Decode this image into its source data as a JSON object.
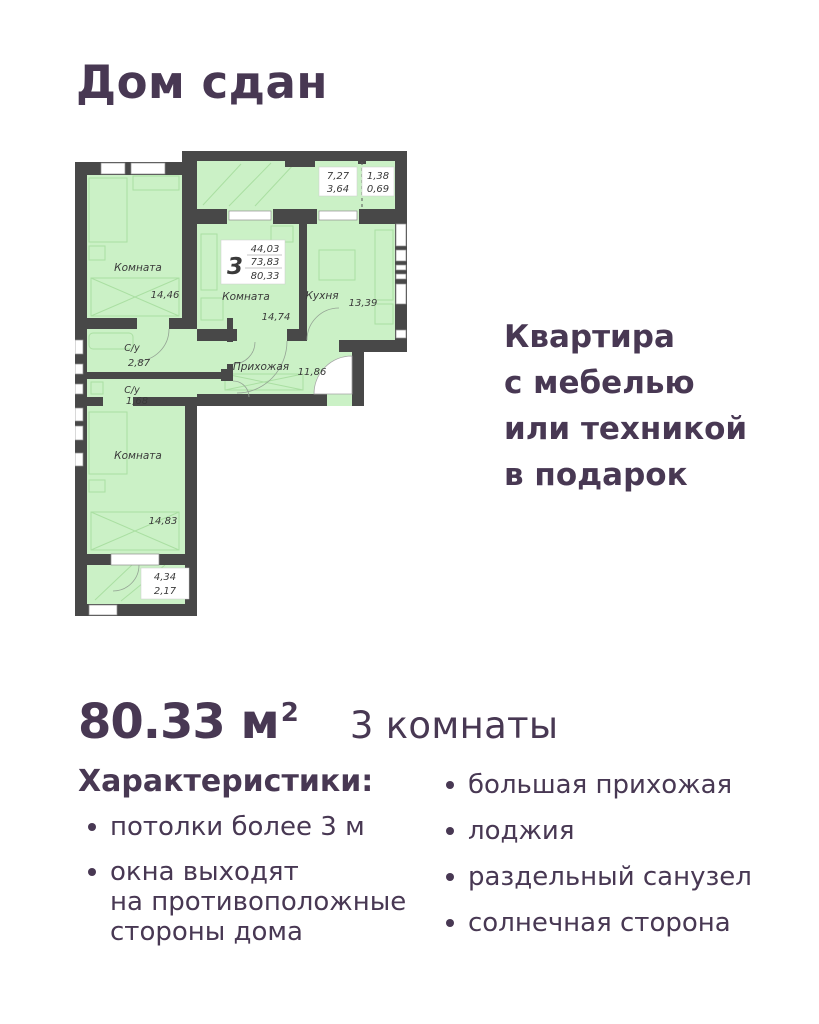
{
  "theme": {
    "text_color": "#483853",
    "background": "#ffffff"
  },
  "page": {
    "title": "Дом сдан",
    "promo": {
      "line1": "Квартира",
      "line2": "с мебелью",
      "line3": "или техникой",
      "line4": "в подарок"
    },
    "summary": {
      "area": "80.33 м",
      "area_sup": "2",
      "rooms": "3 комнаты"
    },
    "characteristics": {
      "heading": "Характеристики:",
      "left_items": [
        {
          "l1": "потолки более 3 м",
          "l2": "",
          "l3": ""
        },
        {
          "l1": "окна выходят",
          "l2": "на противоположные",
          "l3": "стороны дома"
        }
      ],
      "right_items": [
        {
          "label": "большая прихожая"
        },
        {
          "label": "лоджия"
        },
        {
          "label": "раздельный санузел"
        },
        {
          "label": "солнечная сторона"
        }
      ]
    }
  },
  "floor_plan": {
    "colors": {
      "wall": "#484848",
      "room_fill": "#cbf1c6",
      "label_text": "#3a3a3a"
    },
    "stamp": {
      "rooms": "3",
      "area1": "44,03",
      "area2": "73,83",
      "area3": "80,33"
    },
    "rooms": [
      {
        "name": "Комната",
        "area": "14,46"
      },
      {
        "name": "Комната",
        "area": "14,74"
      },
      {
        "name": "Кухня",
        "area": "13,39"
      },
      {
        "name": "С/у",
        "area": "2,87"
      },
      {
        "name": "С/у",
        "area": "1,68"
      },
      {
        "name": "Прихожая",
        "area": "11,86"
      },
      {
        "name": "Комната",
        "area": "14,83"
      }
    ],
    "balconies": [
      {
        "full": "7,27",
        "half": "3,64"
      },
      {
        "full": "1,38",
        "half": "0,69"
      },
      {
        "full": "4,34",
        "half": "2,17"
      }
    ]
  }
}
